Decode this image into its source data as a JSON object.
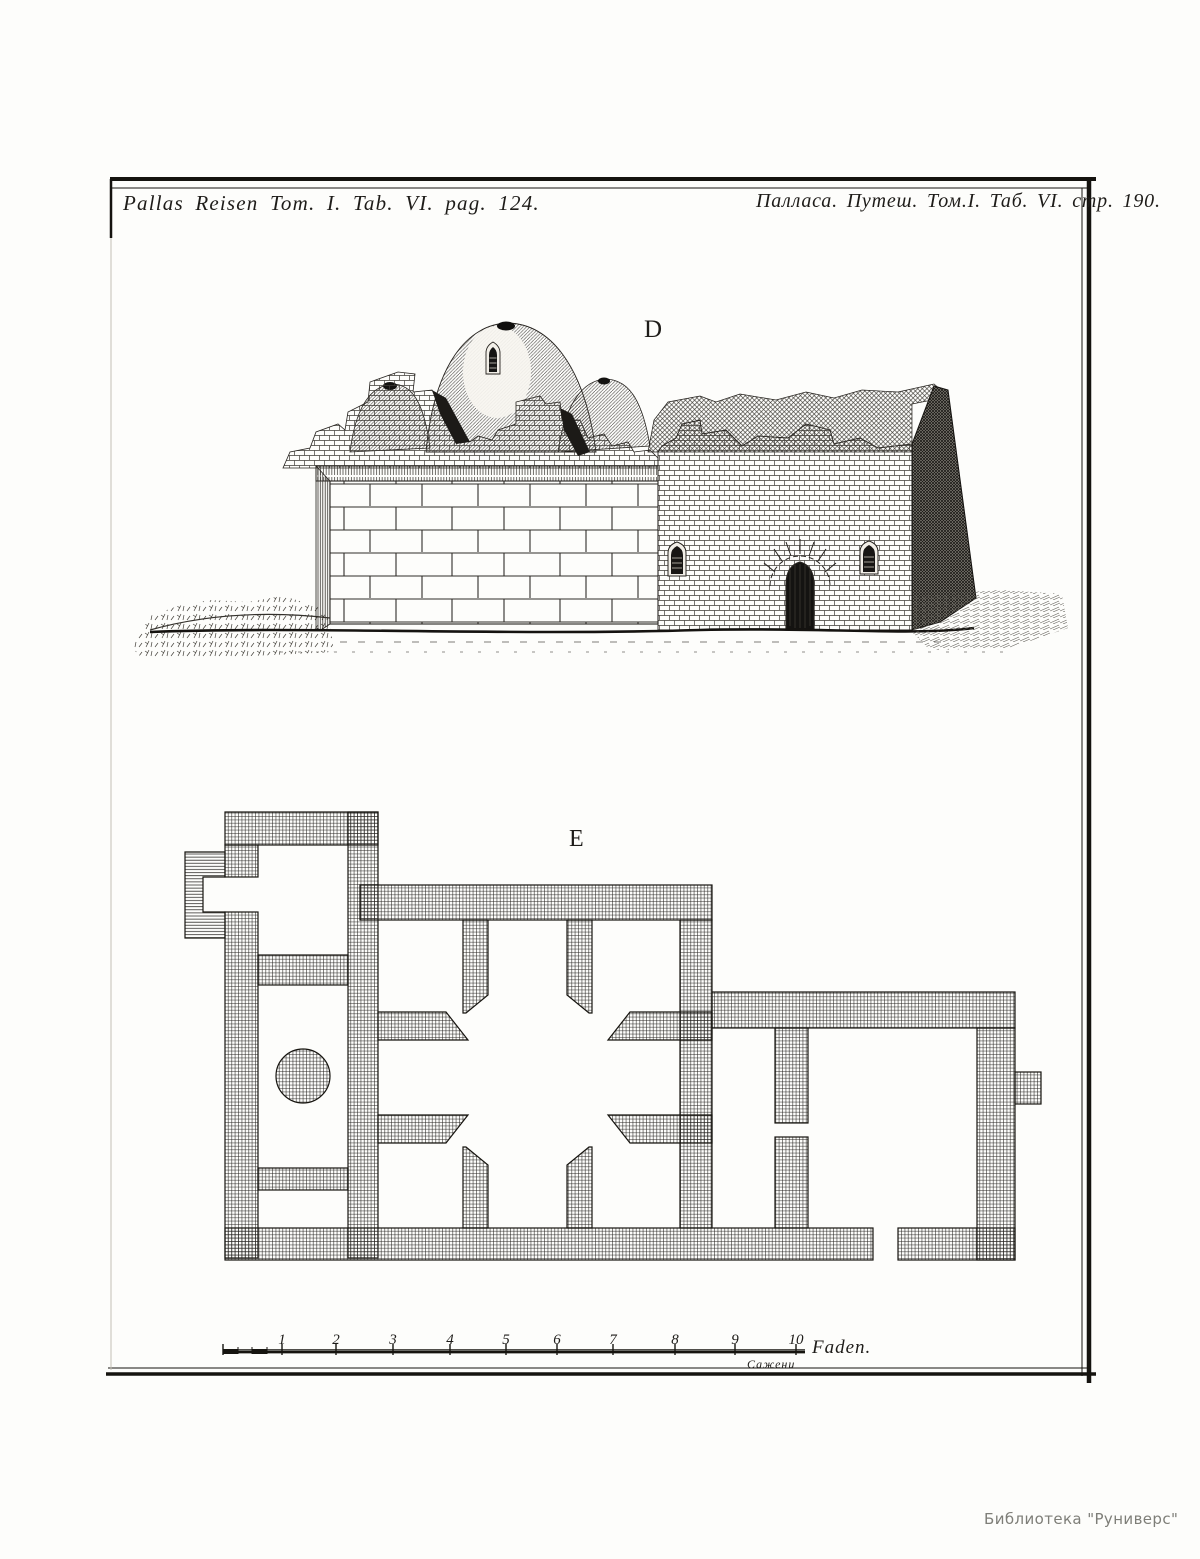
{
  "colors": {
    "paper": "#fdfdfb",
    "ink": "#1c1a18",
    "watermark_gray": "#7e7e78"
  },
  "plate": {
    "header_left": "Pallas Reisen Tom. I. Tab. VI. pag. 124.",
    "header_right": "Палласа. Путеш. Том.I. Таб. VI. стр. 190.",
    "figures": {
      "elevation_label": "D",
      "plan_label": "E"
    },
    "scale_bar": {
      "tick_labels": [
        "1",
        "2",
        "3",
        "4",
        "5",
        "6",
        "7",
        "8",
        "9",
        "10"
      ],
      "unit_latin": "Faden.",
      "unit_cyrillic": "Сажени"
    },
    "watermark": "Библиотека \"Руниверс\""
  }
}
